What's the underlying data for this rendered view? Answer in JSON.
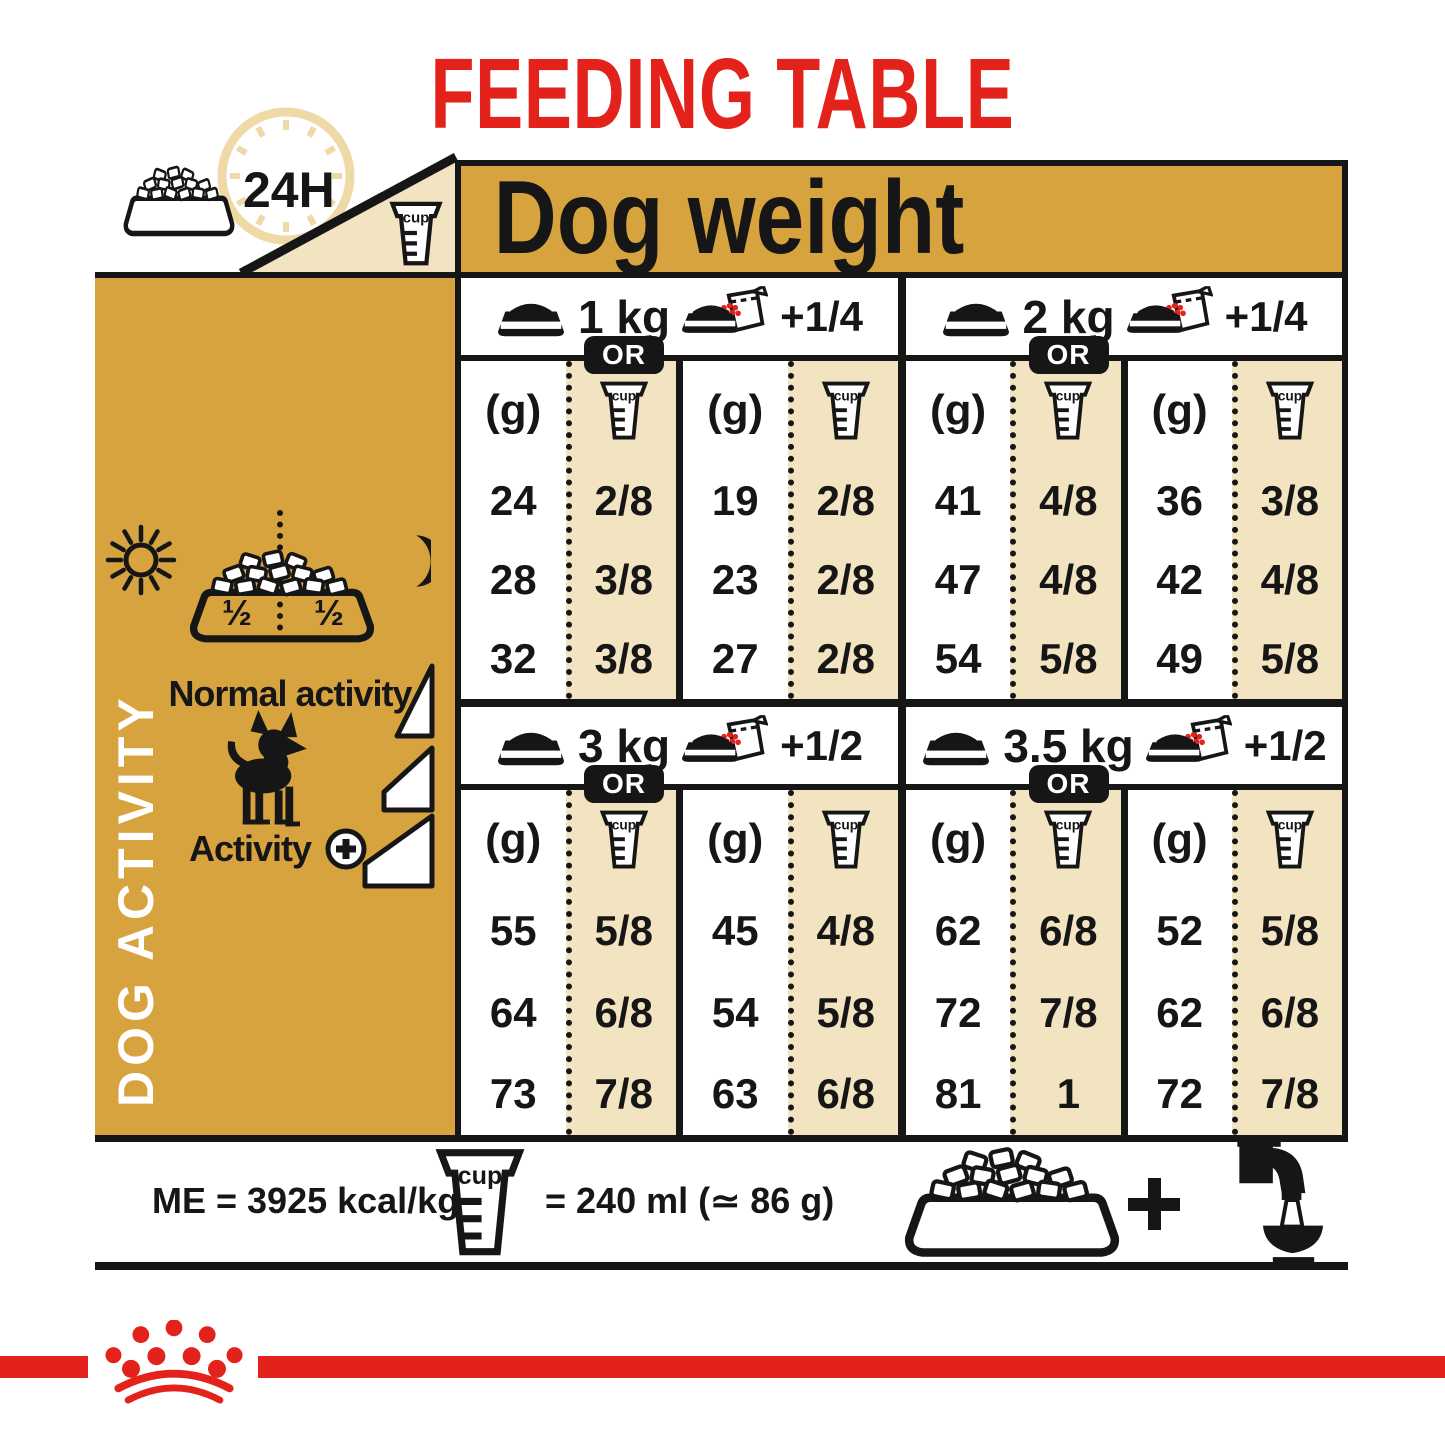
{
  "title": "FEEDING TABLE",
  "colors": {
    "red": "#E3231B",
    "gold": "#D7A33E",
    "cream": "#F3E4C1",
    "ink": "#161616",
    "clock_pale": "#EFD9A6"
  },
  "header": {
    "dog_weight": "Dog weight",
    "daily": "24H"
  },
  "columns": {
    "grams": "(g)",
    "cup": "cup"
  },
  "sections": [
    {
      "weight": "1 kg",
      "or_label": "OR",
      "wet_extra": "+1/4",
      "rows": [
        {
          "dry_g": "24",
          "dry_cup": "2/8",
          "wet_g": "19",
          "wet_cup": "2/8"
        },
        {
          "dry_g": "28",
          "dry_cup": "3/8",
          "wet_g": "23",
          "wet_cup": "2/8"
        },
        {
          "dry_g": "32",
          "dry_cup": "3/8",
          "wet_g": "27",
          "wet_cup": "2/8"
        }
      ]
    },
    {
      "weight": "2 kg",
      "or_label": "OR",
      "wet_extra": "+1/4",
      "rows": [
        {
          "dry_g": "41",
          "dry_cup": "4/8",
          "wet_g": "36",
          "wet_cup": "3/8"
        },
        {
          "dry_g": "47",
          "dry_cup": "4/8",
          "wet_g": "42",
          "wet_cup": "4/8"
        },
        {
          "dry_g": "54",
          "dry_cup": "5/8",
          "wet_g": "49",
          "wet_cup": "5/8"
        }
      ]
    },
    {
      "weight": "3 kg",
      "or_label": "OR",
      "wet_extra": "+1/2",
      "rows": [
        {
          "dry_g": "55",
          "dry_cup": "5/8",
          "wet_g": "45",
          "wet_cup": "4/8"
        },
        {
          "dry_g": "64",
          "dry_cup": "6/8",
          "wet_g": "54",
          "wet_cup": "5/8"
        },
        {
          "dry_g": "73",
          "dry_cup": "7/8",
          "wet_g": "63",
          "wet_cup": "6/8"
        }
      ]
    },
    {
      "weight": "3.5 kg",
      "or_label": "OR",
      "wet_extra": "+1/2",
      "rows": [
        {
          "dry_g": "62",
          "dry_cup": "6/8",
          "wet_g": "52",
          "wet_cup": "5/8"
        },
        {
          "dry_g": "72",
          "dry_cup": "7/8",
          "wet_g": "62",
          "wet_cup": "6/8"
        },
        {
          "dry_g": "81",
          "dry_cup": "1",
          "wet_g": "72",
          "wet_cup": "7/8"
        }
      ]
    }
  ],
  "sidebar": {
    "title": "DOG ACTIVITY",
    "half_left": "½",
    "half_right": "½",
    "normal": "Normal activity",
    "activity": "Activity"
  },
  "footer": {
    "me": "ME = 3925 kcal/kg",
    "cup_eq": "= 240 ml (≃ 86 g)"
  },
  "chart_data": {
    "type": "table",
    "title": "FEEDING TABLE",
    "column_group_header": "Dog weight",
    "row_group_header": "DOG ACTIVITY",
    "activity_labels_visible": [
      "Normal activity",
      "Activity +"
    ],
    "serving_modes": [
      "kibble only (g / cup)",
      "kibble + wet pouch (g / cup)"
    ],
    "notes": [
      "ME = 3925 kcal/kg",
      "cup = 240 ml (≃ 86 g)",
      "ration split ½ / ½ over 24H",
      "fresh water always available"
    ],
    "rations": [
      {
        "dog_weight_kg": 1,
        "wet_pouch_extra": "+1/4",
        "kibble_only": [
          {
            "g": 24,
            "cup": "2/8"
          },
          {
            "g": 28,
            "cup": "3/8"
          },
          {
            "g": 32,
            "cup": "3/8"
          }
        ],
        "with_wet": [
          {
            "g": 19,
            "cup": "2/8"
          },
          {
            "g": 23,
            "cup": "2/8"
          },
          {
            "g": 27,
            "cup": "2/8"
          }
        ]
      },
      {
        "dog_weight_kg": 2,
        "wet_pouch_extra": "+1/4",
        "kibble_only": [
          {
            "g": 41,
            "cup": "4/8"
          },
          {
            "g": 47,
            "cup": "4/8"
          },
          {
            "g": 54,
            "cup": "5/8"
          }
        ],
        "with_wet": [
          {
            "g": 36,
            "cup": "3/8"
          },
          {
            "g": 42,
            "cup": "4/8"
          },
          {
            "g": 49,
            "cup": "5/8"
          }
        ]
      },
      {
        "dog_weight_kg": 3,
        "wet_pouch_extra": "+1/2",
        "kibble_only": [
          {
            "g": 55,
            "cup": "5/8"
          },
          {
            "g": 64,
            "cup": "6/8"
          },
          {
            "g": 73,
            "cup": "7/8"
          }
        ],
        "with_wet": [
          {
            "g": 45,
            "cup": "4/8"
          },
          {
            "g": 54,
            "cup": "5/8"
          },
          {
            "g": 63,
            "cup": "6/8"
          }
        ]
      },
      {
        "dog_weight_kg": 3.5,
        "wet_pouch_extra": "+1/2",
        "kibble_only": [
          {
            "g": 62,
            "cup": "6/8"
          },
          {
            "g": 72,
            "cup": "7/8"
          },
          {
            "g": 81,
            "cup": "1"
          }
        ],
        "with_wet": [
          {
            "g": 52,
            "cup": "5/8"
          },
          {
            "g": 62,
            "cup": "6/8"
          },
          {
            "g": 72,
            "cup": "7/8"
          }
        ]
      }
    ]
  }
}
